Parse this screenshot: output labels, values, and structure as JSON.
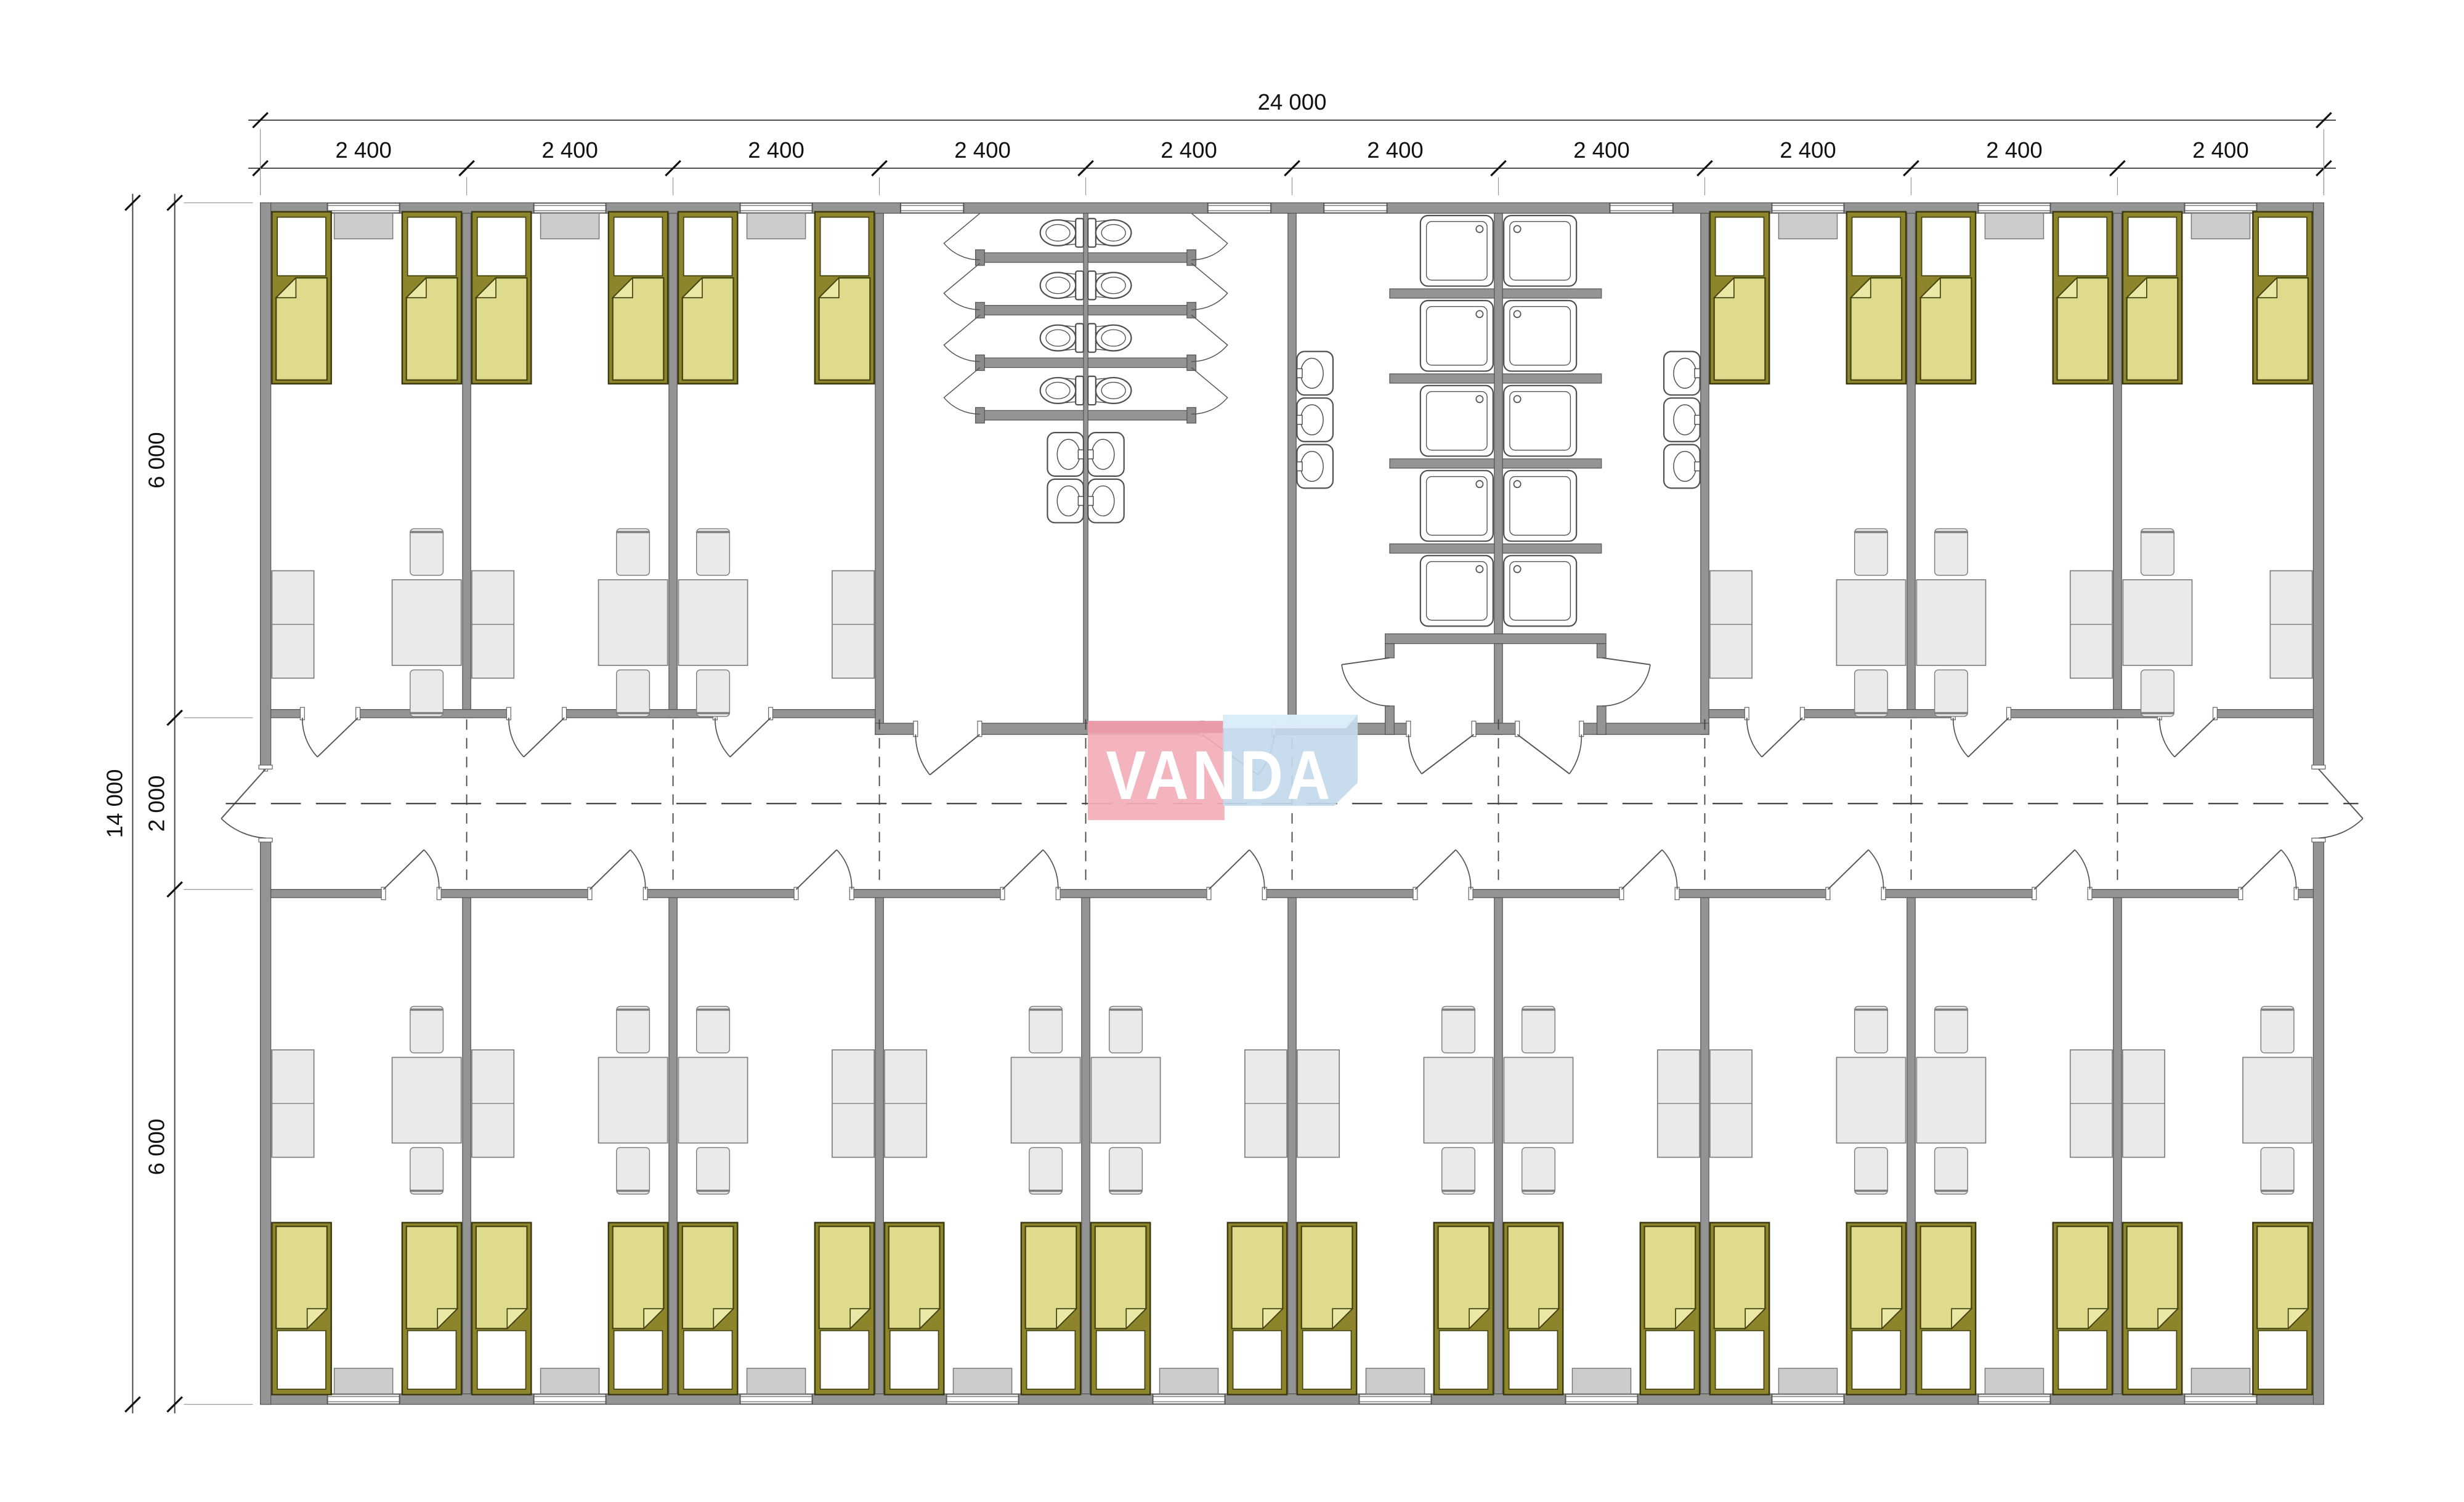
{
  "logo": {
    "text": "VANDA",
    "pink_color": "#f2aeb8",
    "pink_bevel_color": "#ea98a6",
    "blue_color": "#c3d9eb",
    "blue_bevel_color": "#dcedf9",
    "text_color": "#ffffff"
  },
  "dimensions": {
    "top_total": "24 000",
    "top_segments": [
      "2 400",
      "2 400",
      "2 400",
      "2 400",
      "2 400",
      "2 400",
      "2 400",
      "2 400",
      "2 400",
      "2 400"
    ],
    "left_total": "14 000",
    "left_segments": [
      "6 000",
      "2 000",
      "6 000"
    ]
  },
  "plan": {
    "module_count": 10,
    "module_mm": 2400,
    "width_mm": 24000,
    "depth_mm": 14000,
    "band_mm": 6000,
    "corridor_mm": 2000,
    "top_rooms": [
      {
        "module": 0,
        "beds": 2,
        "window": true,
        "locker": "left",
        "table": "right"
      },
      {
        "module": 1,
        "beds": 2,
        "window": true,
        "locker": "left",
        "table": "right"
      },
      {
        "module": 2,
        "beds": 2,
        "window": true,
        "locker": "right",
        "table": "left"
      },
      {
        "module": 7,
        "beds": 2,
        "window": true,
        "locker": "left",
        "table": "right"
      },
      {
        "module": 8,
        "beds": 2,
        "window": true,
        "locker": "right",
        "table": "left"
      },
      {
        "module": 9,
        "beds": 2,
        "window": true,
        "locker": "right",
        "table": "left"
      }
    ],
    "bottom_rooms": [
      {
        "module": 0,
        "beds": 2,
        "window": true,
        "locker": "left",
        "table": "right"
      },
      {
        "module": 1,
        "beds": 2,
        "window": true,
        "locker": "left",
        "table": "right"
      },
      {
        "module": 2,
        "beds": 2,
        "window": true,
        "locker": "right",
        "table": "left"
      },
      {
        "module": 3,
        "beds": 2,
        "window": true,
        "locker": "left",
        "table": "right"
      },
      {
        "module": 4,
        "beds": 2,
        "window": true,
        "locker": "right",
        "table": "left"
      },
      {
        "module": 5,
        "beds": 2,
        "window": true,
        "locker": "left",
        "table": "right"
      },
      {
        "module": 6,
        "beds": 2,
        "window": true,
        "locker": "right",
        "table": "left"
      },
      {
        "module": 7,
        "beds": 2,
        "window": true,
        "locker": "left",
        "table": "right"
      },
      {
        "module": 8,
        "beds": 2,
        "window": true,
        "locker": "right",
        "table": "left"
      },
      {
        "module": 9,
        "beds": 2,
        "window": true,
        "locker": "left",
        "table": "right"
      }
    ],
    "wc_block": {
      "modules": [
        3,
        4
      ],
      "toilet_stalls_per_side": 4,
      "washbasins": 4,
      "windows": 2,
      "doors": 2
    },
    "shower_block": {
      "modules": [
        5,
        6
      ],
      "tray_rows": 5,
      "shower_trays": 10,
      "washbasins": 6,
      "windows": 2,
      "vestibule_doors": 2,
      "fan_doors": 2
    },
    "corridor_end_doors": 2
  },
  "colors": {
    "wall_fill": "#949494",
    "wall_edge": "#555555",
    "bed_frame": "#8c852c",
    "bed_blanket": "#dedb8c",
    "bed_fold": "#ebe8a6",
    "bed_outline": "#3a380f",
    "furniture_fill": "#eaeaea",
    "furniture_edge": "#7f7f7f",
    "sill_fill": "#cccccc",
    "sill_edge": "#777777",
    "fixture_stroke": "#4f4f4f",
    "dash_color": "#333333",
    "dim_line": "#444444",
    "dim_text": "#111111"
  }
}
